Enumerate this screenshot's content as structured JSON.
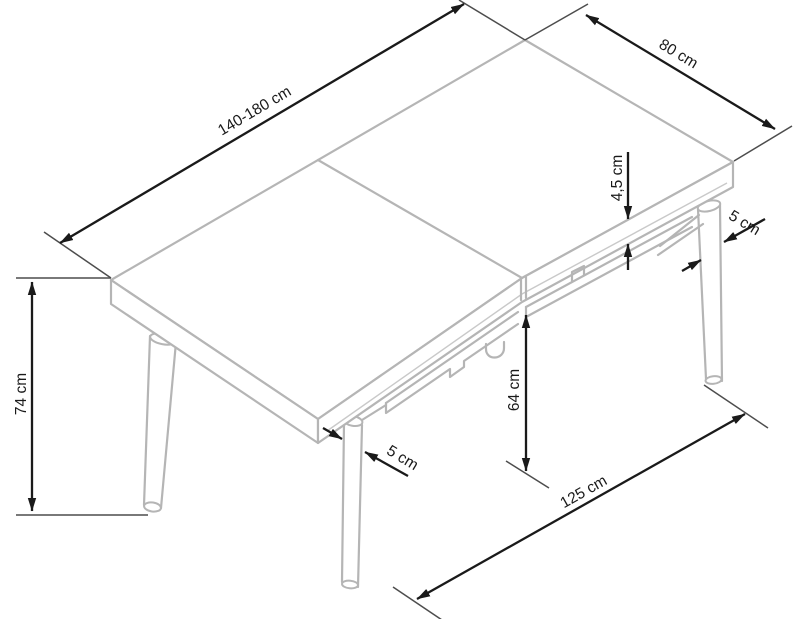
{
  "diagram": {
    "kind": "furniture-dimension-drawing",
    "subject": "extendable rectangular dining table with four splayed round legs",
    "background_color": "#ffffff",
    "table_outline_color": "#b5b5b5",
    "dimension_color": "#1a1a1a",
    "dimensions": {
      "length": "140-180 cm",
      "width": "80 cm",
      "top_thickness": "4,5 cm",
      "leg_diameter_right": "5 cm",
      "height": "74 cm",
      "leg_diameter_left": "5 cm",
      "clearance_under_apron": "64 cm",
      "leg_span": "125 cm"
    }
  }
}
